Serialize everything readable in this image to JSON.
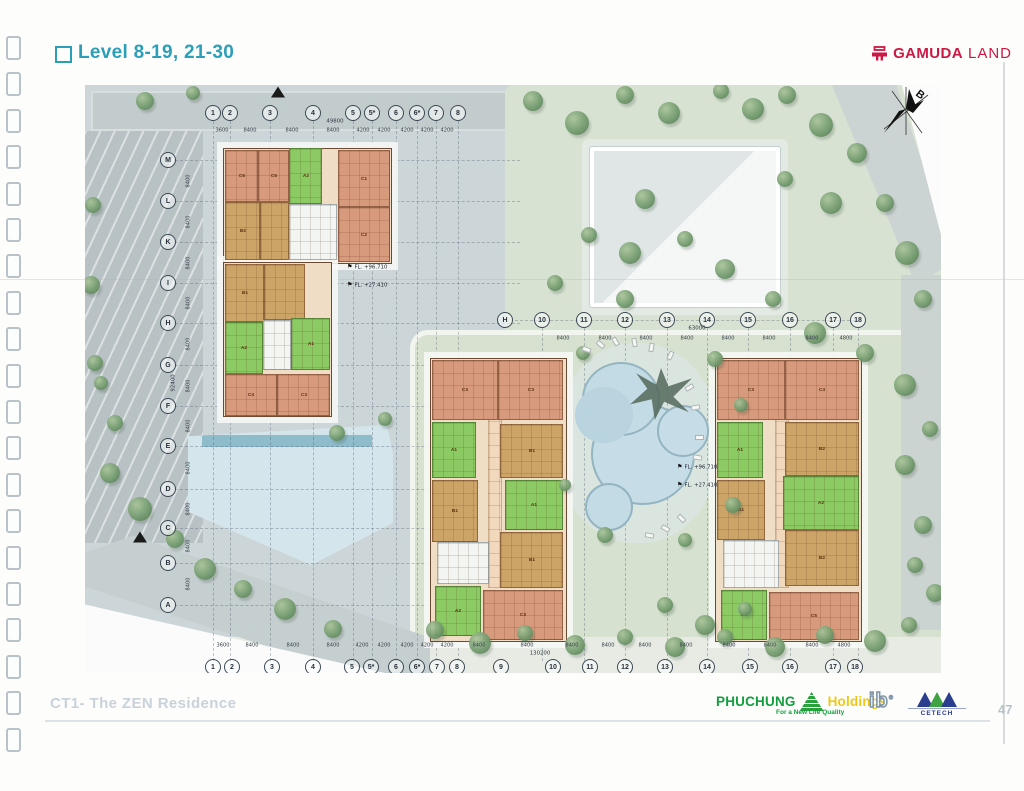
{
  "page": {
    "title": "Level 8-19, 21-30",
    "footer_left": "CT1- The ZEN Residence",
    "page_number": "47"
  },
  "header": {
    "gamuda_word": "GAMUDA",
    "gamuda_suffix": "LAND",
    "gamuda_color": "#cc1843"
  },
  "footer": {
    "phuchung": "PHUCHUNG",
    "holdings": "Holdings",
    "tagline": "For a New Life Quality",
    "ib": "ib",
    "cetech": "CETECH",
    "phuchung_green": "#119f3e",
    "holdings_yellow": "#f0c714",
    "cetech_blue": "#27388f"
  },
  "plan": {
    "north_label": "B",
    "annotations": [
      {
        "x": 262,
        "y": 178,
        "text": "FL. +96.710"
      },
      {
        "x": 262,
        "y": 196,
        "text": "FL. +27.410"
      },
      {
        "x": 592,
        "y": 378,
        "text": "FL. +96.710"
      },
      {
        "x": 592,
        "y": 396,
        "text": "FL. +27.410"
      }
    ],
    "grids": [
      {
        "type": "cols",
        "line_y1": 36,
        "line_y2": 576,
        "label_y": 28,
        "dim_y": 45,
        "total": {
          "text": "49800",
          "x": 250,
          "y": 36
        },
        "items": [
          [
            "1",
            128
          ],
          [
            "2",
            145
          ],
          [
            "3",
            185
          ],
          [
            "4",
            228
          ],
          [
            "5",
            268
          ],
          [
            "5*",
            287
          ],
          [
            "6",
            311
          ],
          [
            "6*",
            332
          ],
          [
            "7",
            351
          ],
          [
            "8",
            373
          ]
        ],
        "dims": [
          "3600",
          "8400",
          "8400",
          "8400",
          "4200",
          "4200",
          "4200",
          "4200",
          "4200"
        ]
      },
      {
        "type": "cols",
        "line_y1": 243,
        "line_y2": 576,
        "label_y": 235,
        "dim_y": 253,
        "total": {
          "text": "63000",
          "x": 612,
          "y": 243
        },
        "items": [
          [
            "H",
            420,
            1
          ],
          [
            "10",
            457
          ],
          [
            "11",
            499
          ],
          [
            "12",
            540
          ],
          [
            "13",
            582
          ],
          [
            "14",
            622
          ],
          [
            "15",
            663
          ],
          [
            "16",
            705
          ],
          [
            "17",
            748
          ],
          [
            "18",
            773
          ]
        ],
        "dims": [
          "",
          "8400",
          "8400",
          "8400",
          "8400",
          "8400",
          "8400",
          "8400",
          "4800"
        ]
      },
      {
        "type": "cols",
        "lines": false,
        "label_y": 582,
        "dim_y": 560,
        "total": {
          "text": "130200",
          "x": 455,
          "y": 568
        },
        "items": [
          [
            "1",
            128
          ],
          [
            "2",
            147
          ],
          [
            "3",
            187
          ],
          [
            "4",
            228
          ],
          [
            "5",
            267
          ],
          [
            "5*",
            286
          ],
          [
            "6",
            311
          ],
          [
            "6*",
            332
          ],
          [
            "7",
            352
          ],
          [
            "8",
            372
          ],
          [
            "9",
            416
          ],
          [
            "10",
            468
          ],
          [
            "11",
            505
          ],
          [
            "12",
            540
          ],
          [
            "13",
            580
          ],
          [
            "14",
            622
          ],
          [
            "15",
            665
          ],
          [
            "16",
            705
          ],
          [
            "17",
            748
          ],
          [
            "18",
            770
          ]
        ],
        "dims": [
          "3600",
          "8400",
          "8400",
          "8400",
          "4200",
          "4200",
          "4200",
          "4200",
          "4200",
          "8400",
          "8400",
          "8400",
          "8400",
          "8400",
          "8400",
          "8400",
          "8400",
          "8400",
          "4800"
        ]
      },
      {
        "type": "rows",
        "line_x1": 90,
        "line_x2": 435,
        "label_x": 83,
        "dim_x": 103,
        "total": {
          "text": "92400",
          "x": 88,
          "y": 298
        },
        "items": [
          [
            "M",
            75
          ],
          [
            "L",
            116
          ],
          [
            "K",
            157
          ],
          [
            "I",
            198
          ],
          [
            "H",
            238
          ],
          [
            "G",
            280
          ],
          [
            "F",
            321
          ],
          [
            "E",
            361
          ],
          [
            "D",
            404
          ],
          [
            "C",
            443
          ],
          [
            "B",
            478
          ],
          [
            "A",
            520
          ]
        ],
        "dims": [
          "8400",
          "8400",
          "8400",
          "8400",
          "8400",
          "8400",
          "8400",
          "8400",
          "8400",
          "8400",
          "8400"
        ]
      }
    ],
    "buildings": [
      {
        "name": "block-a",
        "bases": [
          [
            138,
            63,
            167,
            114
          ],
          [
            138,
            177,
            107,
            153
          ]
        ],
        "blocks": [
          [
            140,
            65,
            31,
            50,
            "o",
            "C6"
          ],
          [
            173,
            65,
            29,
            50,
            "o",
            "C5"
          ],
          [
            204,
            63,
            31,
            54,
            "g",
            "A2"
          ],
          [
            253,
            65,
            50,
            55,
            "o",
            "C1"
          ],
          [
            253,
            122,
            50,
            53,
            "o",
            "C2"
          ],
          [
            140,
            117,
            33,
            56,
            "t",
            "B2"
          ],
          [
            175,
            117,
            27,
            56,
            "t",
            ""
          ],
          [
            204,
            119,
            46,
            54,
            "w",
            ""
          ],
          [
            140,
            179,
            37,
            56,
            "t",
            "B1"
          ],
          [
            179,
            179,
            39,
            54,
            "t",
            ""
          ],
          [
            140,
            237,
            36,
            50,
            "g",
            "A2"
          ],
          [
            178,
            235,
            26,
            48,
            "w",
            ""
          ],
          [
            206,
            233,
            37,
            50,
            "g",
            "A1"
          ],
          [
            140,
            289,
            50,
            40,
            "o",
            "C4"
          ],
          [
            192,
            289,
            51,
            40,
            "o",
            "C3"
          ]
        ]
      },
      {
        "name": "block-b",
        "bases": [
          [
            345,
            273,
            135,
            282
          ]
        ],
        "blocks": [
          [
            403,
            275,
            12,
            226,
            "c",
            ""
          ],
          [
            347,
            275,
            64,
            58,
            "o",
            "C3"
          ],
          [
            413,
            275,
            63,
            58,
            "o",
            "C3"
          ],
          [
            347,
            337,
            42,
            54,
            "g",
            "A1"
          ],
          [
            415,
            339,
            61,
            52,
            "t",
            "B1"
          ],
          [
            347,
            395,
            44,
            60,
            "t",
            "B1"
          ],
          [
            420,
            395,
            56,
            48,
            "g",
            "A1"
          ],
          [
            415,
            447,
            61,
            54,
            "t",
            "B1"
          ],
          [
            352,
            457,
            50,
            40,
            "w",
            ""
          ],
          [
            350,
            501,
            44,
            48,
            "g",
            "A2"
          ],
          [
            398,
            505,
            78,
            48,
            "o",
            "C3"
          ]
        ]
      },
      {
        "name": "block-c",
        "bases": [
          [
            630,
            273,
            145,
            282
          ]
        ],
        "blocks": [
          [
            690,
            275,
            12,
            226,
            "c",
            ""
          ],
          [
            632,
            275,
            66,
            58,
            "o",
            "C3"
          ],
          [
            700,
            275,
            72,
            58,
            "o",
            "C4"
          ],
          [
            632,
            337,
            44,
            54,
            "g",
            "A1"
          ],
          [
            700,
            337,
            72,
            52,
            "t",
            "B2"
          ],
          [
            632,
            395,
            46,
            58,
            "t",
            "B1"
          ],
          [
            698,
            391,
            74,
            52,
            "g",
            "A2"
          ],
          [
            700,
            445,
            72,
            54,
            "t",
            "B2"
          ],
          [
            638,
            455,
            54,
            46,
            "w",
            ""
          ],
          [
            636,
            505,
            44,
            48,
            "g",
            "A2"
          ],
          [
            684,
            507,
            88,
            46,
            "o",
            "C5"
          ]
        ]
      }
    ]
  }
}
